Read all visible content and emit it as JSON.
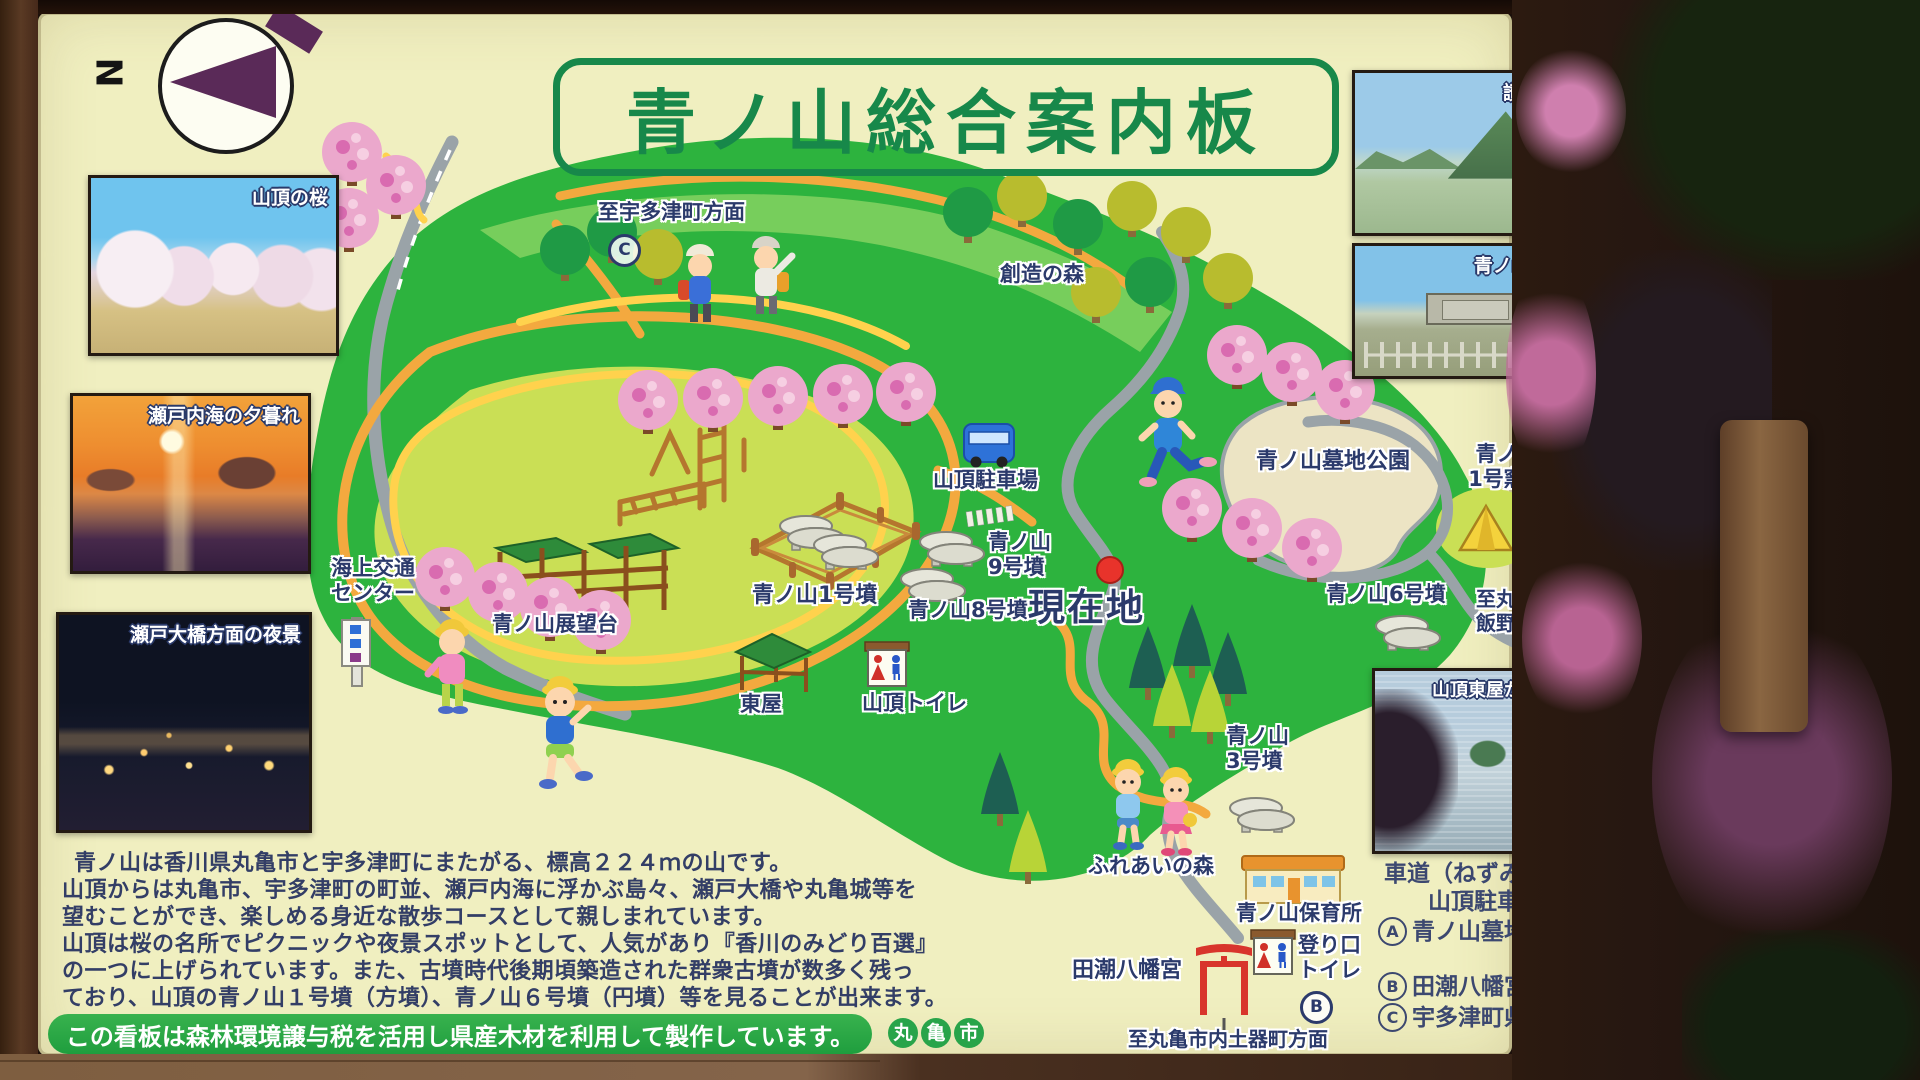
{
  "title": "青ノ山総合案内板",
  "compass": {
    "n": "N"
  },
  "photos_left": [
    {
      "label": "山頂の桜"
    },
    {
      "label": "瀬戸内海の夕暮れ"
    },
    {
      "label": "瀬戸大橋方面の夜景"
    }
  ],
  "photos_right": [
    {
      "label": "讃岐富士"
    },
    {
      "label": "青ノ山1号墳"
    },
    {
      "label": "山頂東屋からの丸亀城"
    }
  ],
  "map": {
    "to_utazu": "至宇多津町方面",
    "mark_c": "C",
    "souzou_forest": "創造の森",
    "parking": "山頂駐車場",
    "tomb9": "青ノ山\n9号墳",
    "tomb8": "青ノ山8号墳",
    "tomb1": "青ノ山1号墳",
    "kaijo": "海上交通\nセンター",
    "tenbodai": "青ノ山展望台",
    "azumaya": "東屋",
    "summit_toilet": "山頂トイレ",
    "current": "現在地",
    "cemetery": "青ノ山墓地公園",
    "kiln": "青ノ山\n1号窯跡",
    "tomb6": "青ノ山6号墳",
    "mark_a": "A",
    "to_iino": "至丸亀市内\n飯野町方面",
    "tomb3": "青ノ山\n3号墳",
    "fureai": "ふれあいの森",
    "nursery": "青ノ山保育所",
    "entrance_toilet": "登り口\nトイレ",
    "mark_b": "B",
    "hachimangu": "田潮八幡宮",
    "to_doki": "至丸亀市内土器町方面"
  },
  "description": {
    "lines": [
      "青ノ山は香川県丸亀市と宇多津町にまたがる、標高２２４ｍの山です。",
      "山頂からは丸亀市、宇多津町の町並、瀬戸内海に浮かぶ島々、瀬戸大橋や丸亀城等を",
      "望むことができ、楽しめる身近な散歩コースとして親しまれています。",
      "山頂は桜の名所でピクニックや夜景スポットとして、人気があり『香川のみどり百選』",
      "の一つに上げられています。また、古墳時代後期頃築造された群衆古墳が数多く残っ",
      "ており、山頂の青ノ山１号墳（方墳）、青ノ山６号墳（円墳）等を見ることが出来ます。"
    ]
  },
  "banner": {
    "text": "この看板は森林環境譲与税を活用し県産木材を利用して製作しています。",
    "city_chars": [
      "丸",
      "亀",
      "市"
    ]
  },
  "routes": {
    "header1": "車道（ねずみ色）利用で",
    "header2": "山頂駐車場までの距離",
    "items": [
      {
        "mark": "A",
        "name": "青ノ山墓地公園ルート",
        "dist": "約3.2km"
      },
      {
        "mark": "B",
        "name": "田潮八幡宮ルート",
        "dist": "約2.8km"
      },
      {
        "mark": "C",
        "name": "宇多津町県道194号線ルート",
        "dist": "約2.2km"
      }
    ]
  },
  "colors": {
    "board": "#f0efc0",
    "hill_green": "#2db33e",
    "summit": "#cadf55",
    "path_orange": "#f3a93f",
    "path_yellow": "#ffd24d",
    "road_gray": "#9aa3a8",
    "title_green": "#17884a",
    "label_navy": "#2b3a6b",
    "banner_green": "#28a44a"
  }
}
